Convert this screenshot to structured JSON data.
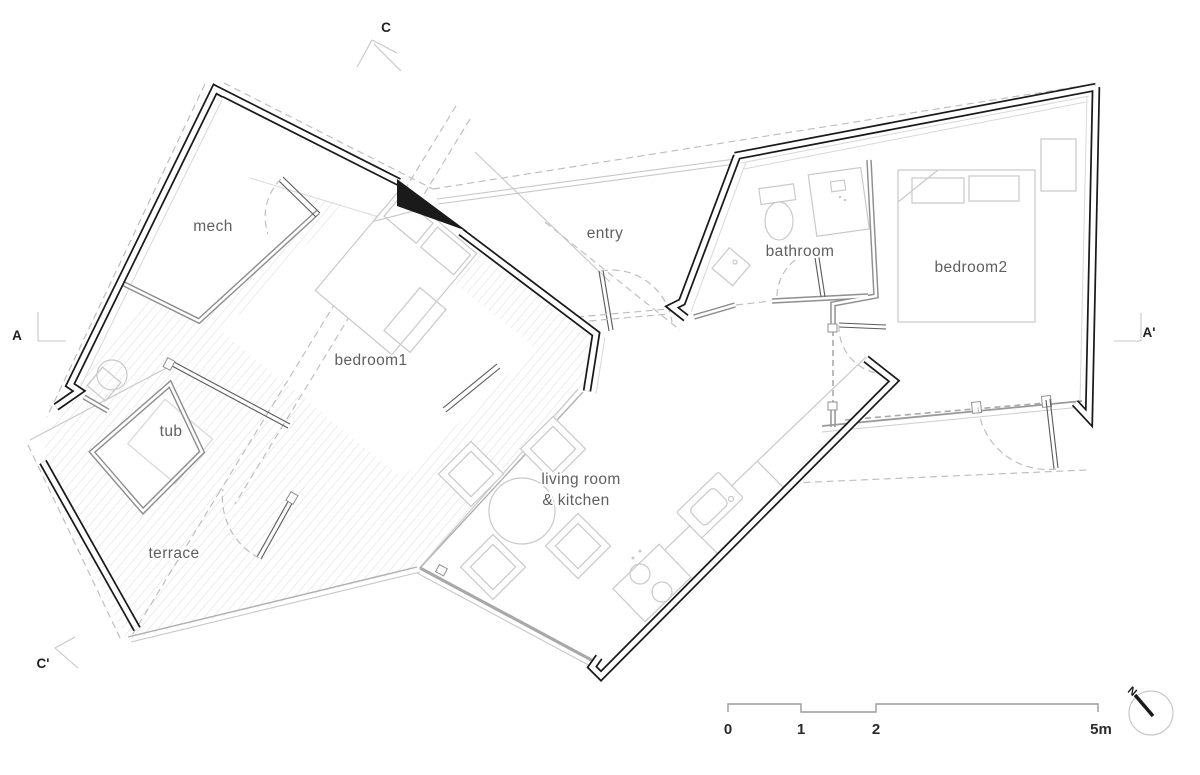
{
  "plan": {
    "title": "apartment floor plan",
    "room_labels": {
      "mech": "mech",
      "bedroom1": "bedroom1",
      "tub": "tub",
      "terrace": "terrace",
      "entry": "entry",
      "bathroom": "bathroom",
      "bedroom2": "bedroom2",
      "living_kitchen_line1": "living room",
      "living_kitchen_line2": "& kitchen"
    },
    "section_markers": {
      "top": "C",
      "bottom_left": "C'",
      "left": "A",
      "right": "A'"
    },
    "scale_bar": {
      "ticks": [
        "0",
        "1",
        "2",
        "5m"
      ]
    },
    "north_label": "N",
    "colors": {
      "wall": "#1a1a1a",
      "interior_wall": "#8f8f8f",
      "furniture": "#c9c9c9",
      "dashed": "#bdbdbd",
      "label_text": "#5f5f5f"
    }
  }
}
